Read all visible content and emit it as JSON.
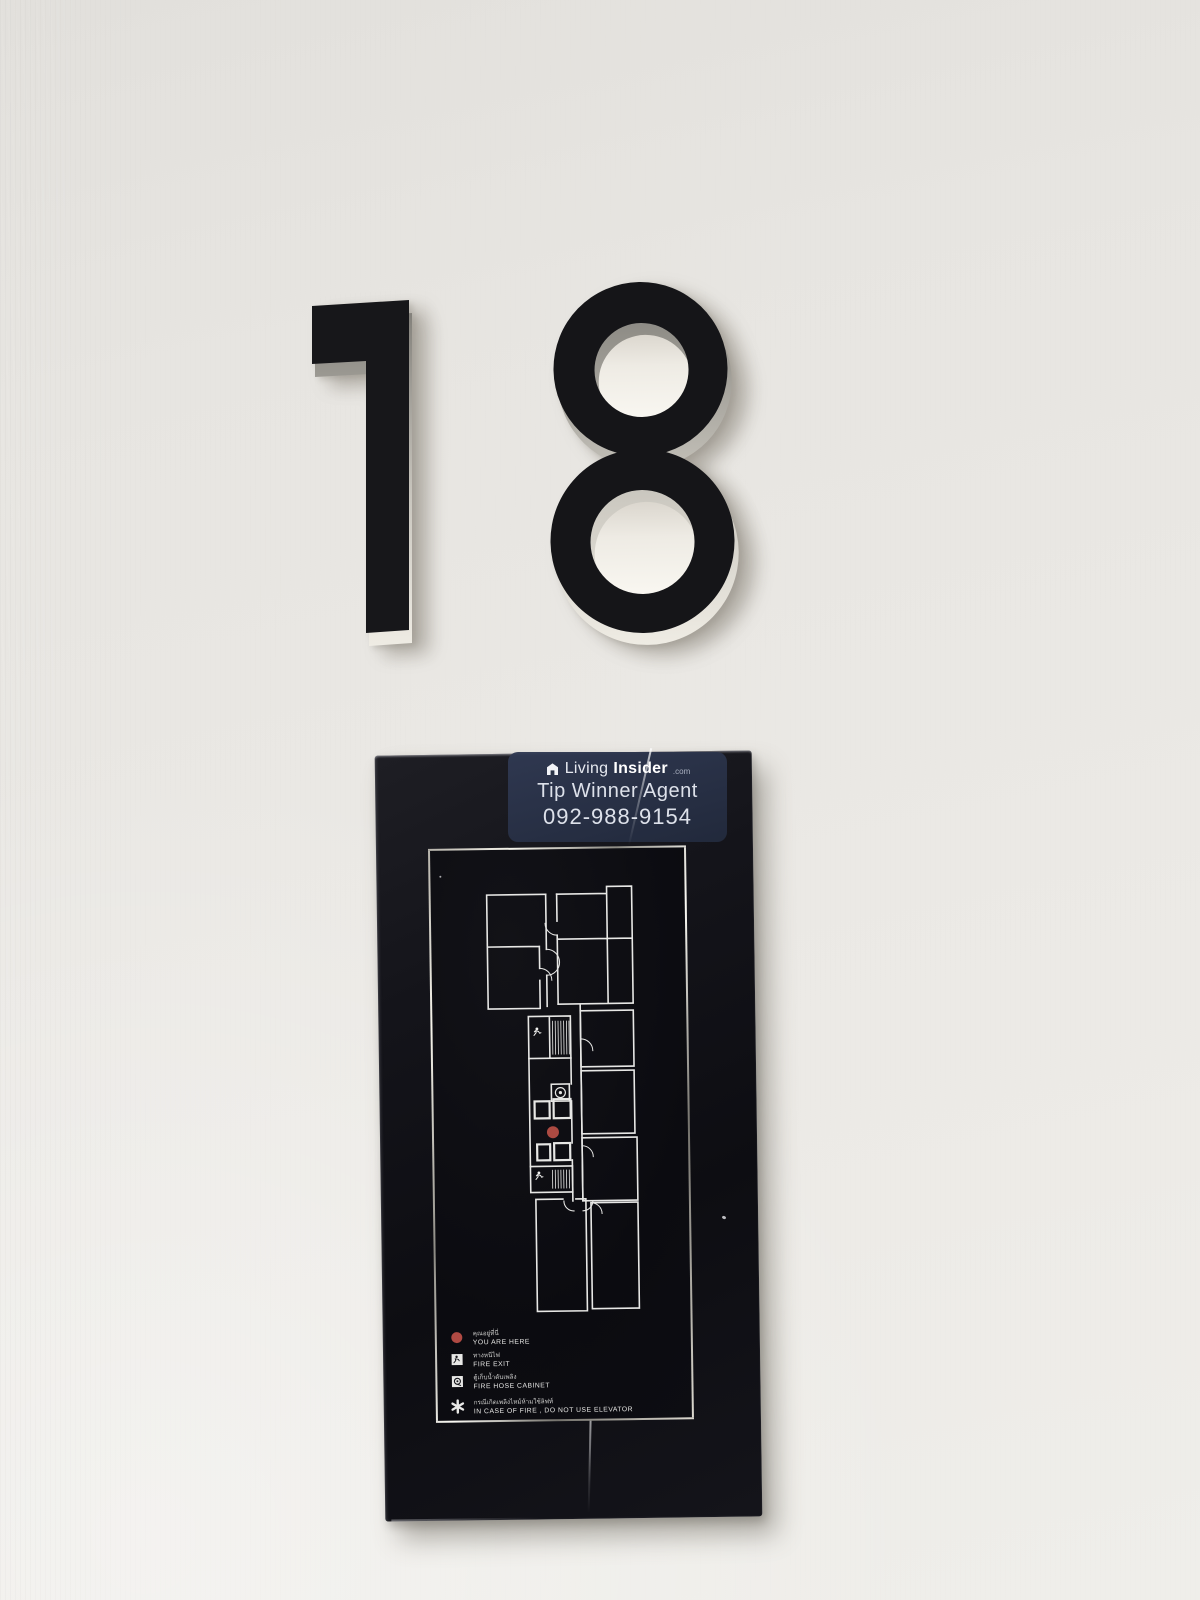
{
  "scene": {
    "description": "Photo of condominium 18th-floor wall: 3D number 18 above a black fire-evacuation floor-plan sign",
    "wall_color": "#eae8e4"
  },
  "floor": {
    "number": "18"
  },
  "watermark": {
    "brand_living": "Living",
    "brand_insider": "Insider",
    "brand_tld": ".com",
    "line1": "Tip Winner Agent",
    "line2": "092-988-9154",
    "bg_color": "#2a3347",
    "text_color": "#dde1ea",
    "logo_icon": "house-cube"
  },
  "sign": {
    "panel_color": "#0d0d12",
    "frame_color": "#d9d6cd",
    "plan_line_color": "#e7e7e5",
    "you_are_here_color": "#ac4a42",
    "icons": {
      "you_are_here": "red-dot",
      "fire_exit": "running-person",
      "fire_hose_cabinet": "hose-reel",
      "note": "asterisk"
    },
    "legend": [
      {
        "icon": "you-are-here-dot",
        "th": "คุณอยู่ที่นี่",
        "en": "YOU ARE HERE"
      },
      {
        "icon": "fire-exit-icon",
        "th": "ทางหนีไฟ",
        "en": "FIRE EXIT"
      },
      {
        "icon": "fire-hose-cabinet-icon",
        "th": "ตู้เก็บน้ำดับเพลิง",
        "en": "FIRE HOSE CABINET"
      },
      {
        "icon": "asterisk-icon",
        "th": "กรณีเกิดเพลิงไหม้ห้ามใช้ลิฟท์",
        "en": "IN CASE OF FIRE , DO NOT USE ELEVATOR"
      }
    ]
  }
}
